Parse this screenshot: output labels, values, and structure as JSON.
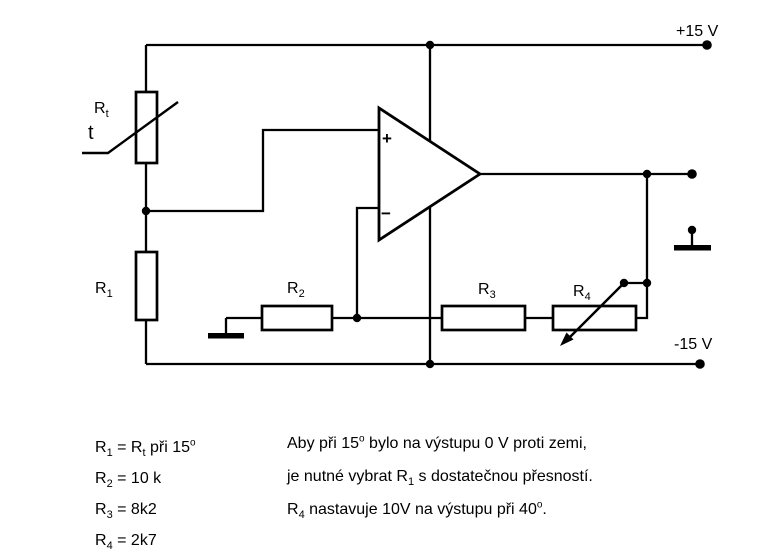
{
  "circuit": {
    "power": {
      "positive_rail_label": "+15 V",
      "negative_rail_label": "-15 V"
    },
    "opamp": {
      "plus_label": "+",
      "minus_label": "−"
    },
    "components": {
      "rt": {
        "base": "R",
        "sub": "t"
      },
      "t": "t",
      "r1": {
        "base": "R",
        "sub": "1"
      },
      "r2": {
        "base": "R",
        "sub": "2"
      },
      "r3": {
        "base": "R",
        "sub": "3"
      },
      "r4": {
        "base": "R",
        "sub": "4"
      }
    }
  },
  "notes": {
    "left": [
      {
        "p0": "R",
        "s0": "1",
        "p1": " = R",
        "s1": "t",
        "p2": " při 15",
        "sup": "o"
      },
      {
        "p0": "R",
        "s0": "2",
        "p1": " = 10 k"
      },
      {
        "p0": "R",
        "s0": "3",
        "p1": " = 8k2"
      },
      {
        "p0": "R",
        "s0": "4",
        "p1": " = 2k7"
      }
    ],
    "right": [
      {
        "p0": "Aby při 15",
        "sup0": "o",
        "p1": " bylo na výstupu 0 V proti zemi,"
      },
      {
        "p0": "je nutné vybrat R",
        "s0": "1",
        "p1": " s dostatečnou přesností."
      },
      {
        "p0": "R",
        "s0": "4",
        "p1": " nastavuje 10V na výstupu při 40",
        "sup1": "o",
        "p2": "."
      }
    ]
  },
  "colors": {
    "ink": "#000000",
    "background": "#ffffff"
  }
}
